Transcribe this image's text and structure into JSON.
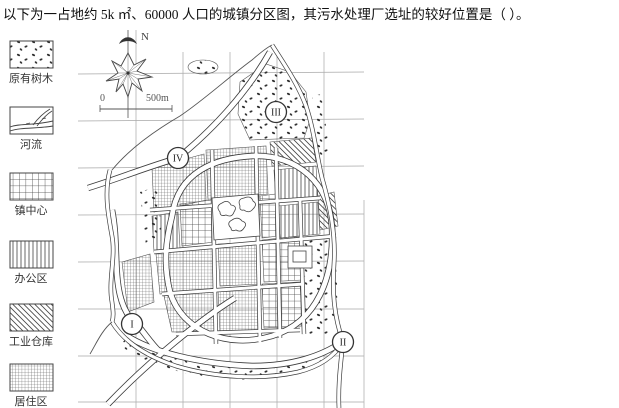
{
  "title": "以下为一占地约 5k ㎡、60000 人口的城镇分区图，其污水处理厂选址的较好位置是（  ）。",
  "legend": {
    "items": [
      {
        "label": "原有树木",
        "pattern": "scattered-trees"
      },
      {
        "label": "河流",
        "pattern": "river"
      },
      {
        "label": "镇中心",
        "pattern": "coarse-grid"
      },
      {
        "label": "办公区",
        "pattern": "vertical-lines"
      },
      {
        "label": "工业仓库",
        "pattern": "diagonal-hatch"
      },
      {
        "label": "居住区",
        "pattern": "fine-grid"
      }
    ]
  },
  "map": {
    "north_label": "N",
    "scale_bar": {
      "start_label": "0",
      "end_label": "500m"
    },
    "site_markers": [
      {
        "numeral": "I",
        "x": 132,
        "y": 324
      },
      {
        "numeral": "II",
        "x": 343,
        "y": 342
      },
      {
        "numeral": "III",
        "x": 276,
        "y": 112
      },
      {
        "numeral": "IV",
        "x": 178,
        "y": 158
      }
    ]
  },
  "colors": {
    "ink": "#3c3c3c",
    "grid_line": "#a8a8a8",
    "paper": "#ffffff"
  }
}
